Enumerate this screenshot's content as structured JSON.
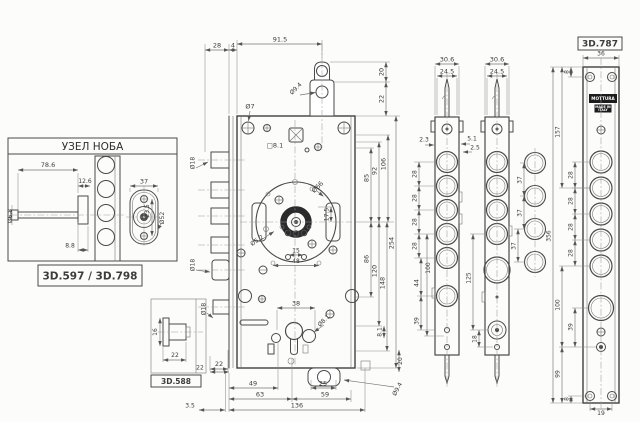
{
  "meta": {
    "type": "lock-mechanism-technical-drawing",
    "background": "#fcfcfb",
    "line_color": "#4a4a4a",
    "dim_color": "#767676",
    "brand_plate_color": "#1c1c1c"
  },
  "titles": {
    "knob_box": "УЗЕЛ НОБА",
    "knob_code": "3D.597 / 3D.798",
    "detail_code": "3D.588",
    "faceplate_code": "3D.787",
    "brand": "MOTTURA",
    "made_in_1": "MADE IN",
    "made_in_2": "ITALY"
  },
  "dims": {
    "knob_len": "78.6",
    "knob_off": "12.6",
    "knob_tail": "8.8",
    "knob_shaft": "Ø6.8",
    "knob_w": "37",
    "knob_cc": "23.5",
    "knob_rose": "Ø52",
    "d588_h": "16",
    "d588_len": "22",
    "d588_off": "22",
    "d588_dia": "Ø18",
    "top28": "28",
    "top4": "4",
    "top915": "91.5",
    "dia7": "Ø7",
    "tabdia": "Ø9.4",
    "tab20": "20",
    "tab22": "22",
    "sq81": "□8.1",
    "dia18u": "Ø18",
    "dia18l": "Ø18",
    "r85": "85",
    "r92": "92",
    "r106": "106",
    "r86": "86",
    "r120": "120",
    "r148": "148",
    "r254": "254",
    "pump66": "Ø66",
    "pump52": "Ø5.2",
    "pump175": "17.5",
    "cc15": "15",
    "cc48": "48",
    "key38": "38",
    "key81": "Ø8.1",
    "off81": "8.1",
    "bl22": "22",
    "b49": "49",
    "b63": "63",
    "b25": "25",
    "b59": "59",
    "b136": "136",
    "b35": "3.5",
    "br20": "20",
    "btab": "Ø9.4",
    "aw1": "30.6",
    "aw2": "24.5",
    "a23": "2.3",
    "a51": "5.1",
    "a25": "2.5",
    "a28a": "28",
    "a28b": "28",
    "a28c": "28",
    "a28d": "28",
    "a100": "100",
    "a44": "44",
    "a39": "39",
    "bw1": "30.6",
    "bw2": "24.5",
    "b125": "125",
    "b18": "18",
    "c37a": "37",
    "c37b": "37",
    "c37c": "37",
    "d36": "36",
    "d8t": "8",
    "d157": "157",
    "d28a": "28",
    "d28b": "28",
    "d28c": "28",
    "d28d": "28",
    "d356": "356",
    "d100": "100",
    "d39": "39",
    "d99": "99",
    "d8b": "8",
    "d19": "19"
  }
}
